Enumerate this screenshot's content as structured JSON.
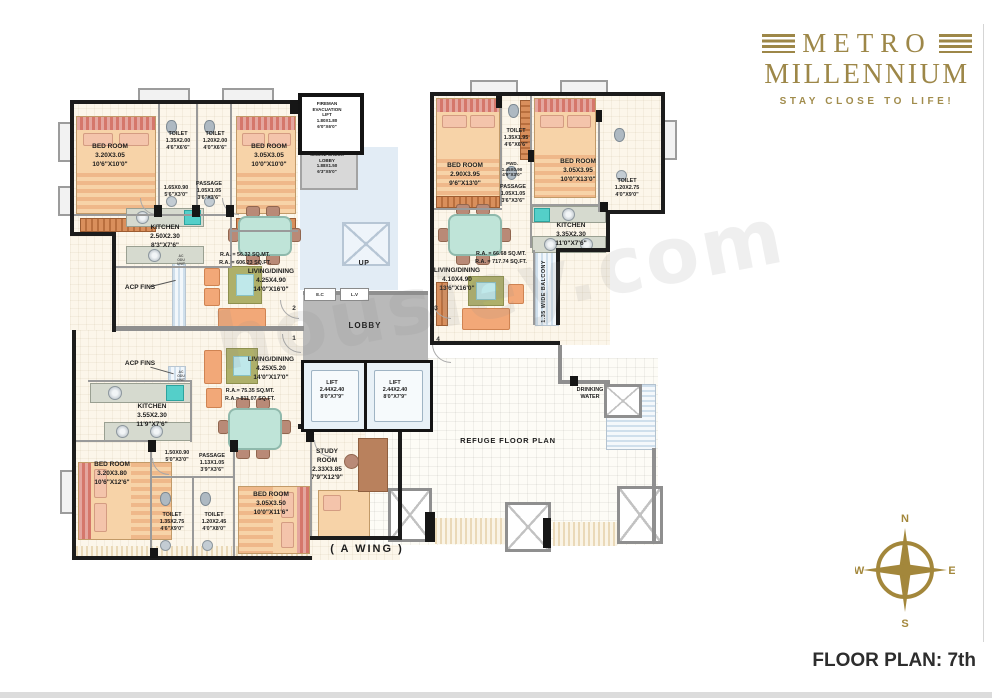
{
  "brand": {
    "name_line1": "METRO",
    "name_line2": "MILLENNIUM",
    "tagline": "STAY CLOSE TO LIFE!"
  },
  "watermark": "housiey.com",
  "plan_title": "FLOOR PLAN: 7th",
  "wing": "( A WING )",
  "compass": {
    "n": "N",
    "e": "E",
    "s": "S",
    "w": "W"
  },
  "core": {
    "fireman_lift": {
      "l1": "FIREMAN",
      "l2": "EVACUATION",
      "l3": "LIFT",
      "dim_m": "1.80X1.80",
      "dim_ft": "6'0\"X6'0\""
    },
    "smoke_lobby": {
      "l1": "SMOKE CHECK",
      "l2": "LOBBY",
      "dim_m": "1.88X1.50",
      "dim_ft": "6'3\"X5'0\""
    },
    "up": "UP",
    "ec": "E.C",
    "lv": "L.V",
    "lobby": "LOBBY",
    "lift": {
      "name": "LIFT",
      "dim_m": "2.44X2.40",
      "dim_ft": "8'0\"X7'9\""
    },
    "flat1": "1",
    "flat2": "2",
    "flat3": "3",
    "flat4": "4"
  },
  "flat_top_left": {
    "bedroom1": {
      "name": "BED ROOM",
      "dim_m": "3.20X3.05",
      "dim_ft": "10'6\"X10'0\""
    },
    "toilet1": {
      "name": "TOILET",
      "dim_m": "1.35X2.00",
      "dim_ft": "4'6\"X6'6\""
    },
    "toilet2": {
      "name": "TOILET",
      "dim_m": "1.20X2.00",
      "dim_ft": "4'0\"X6'6\""
    },
    "bedroom2": {
      "name": "BED ROOM",
      "dim_m": "3.05X3.05",
      "dim_ft": "10'0\"X10'0\""
    },
    "lobby_dim": {
      "dim_m": "1.65X0.90",
      "dim_ft": "5'6\"X3'0\""
    },
    "passage": {
      "name": "PASSAGE",
      "dim_m": "1.05X1.05",
      "dim_ft": "3'6\"X3'6\""
    },
    "kitchen": {
      "name": "KITCHEN",
      "dim_m": "2.50X2.30",
      "dim_ft": "8'3\"X7'6\""
    },
    "ra_mt": "R.A. = 56.32 SQ.MT.",
    "ra_ft": "R.A. = 606.23 SQ.FT.",
    "living": {
      "name": "LIVING/DINING",
      "dim_m": "4.25X4.90",
      "dim_ft": "14'0\"X16'0\""
    }
  },
  "flat_top_right": {
    "bedroom1": {
      "name": "BED ROOM",
      "dim_m": "2.90X3.95",
      "dim_ft": "9'6\"X13'0\""
    },
    "toilet1": {
      "name": "TOILET",
      "dim_m": "1.35X1.95",
      "dim_ft": "4'6\"X6'6\""
    },
    "pwd": {
      "name": "PWD.",
      "dim_m": "1.45X0.90",
      "dim_ft": "4'9\"X3'0\""
    },
    "passage": {
      "name": "PASSAGE",
      "dim_m": "1.05X1.05",
      "dim_ft": "3'6\"X3'6\""
    },
    "bedroom2": {
      "name": "BED ROOM",
      "dim_m": "3.05X3.95",
      "dim_ft": "10'0\"X13'0\""
    },
    "toilet2": {
      "name": "TOILET",
      "dim_m": "1.20X2.75",
      "dim_ft": "4'0\"X9'0\""
    },
    "kitchen": {
      "name": "KITCHEN",
      "dim_m": "3.35X2.30",
      "dim_ft": "11'0\"X7'6\""
    },
    "ra_mt": "R.A. = 66.68 SQ.MT.",
    "ra_ft": "R.A. = 717.74 SQ.FT.",
    "living": {
      "name": "LIVING/DINING",
      "dim_m": "4.10X4.90",
      "dim_ft": "13'6\"X16'0\""
    },
    "balcony": "1.35 WIDE BALCONY"
  },
  "flat_bottom_left": {
    "kitchen": {
      "name": "KITCHEN",
      "dim_m": "3.55X2.30",
      "dim_ft": "11'9\"X7'6\""
    },
    "living": {
      "name": "LIVING/DINING",
      "dim_m": "4.25X5.20",
      "dim_ft": "14'0\"X17'0\""
    },
    "ra_mt": "R.A.= 75.35 SQ.MT.",
    "ra_ft": "R.A.= 811.07 SQ.FT.",
    "lobby_dim": {
      "dim_m": "1.50X0.90",
      "dim_ft": "5'0\"X3'0\""
    },
    "passage": {
      "name": "PASSAGE",
      "dim_m": "1.13X1.05",
      "dim_ft": "3'9\"X3'6\""
    },
    "bedroom1": {
      "name": "BED ROOM",
      "dim_m": "3.20X3.80",
      "dim_ft": "10'6\"X12'6\""
    },
    "toilet1": {
      "name": "TOILET",
      "dim_m": "1.35X2.75",
      "dim_ft": "4'6\"X9'0\""
    },
    "toilet2": {
      "name": "TOILET",
      "dim_m": "1.20X2.45",
      "dim_ft": "4'0\"X8'0\""
    },
    "bedroom2": {
      "name": "BED ROOM",
      "dim_m": "3.05X3.50",
      "dim_ft": "10'0\"X11'6\""
    },
    "study": {
      "name1": "STUDY",
      "name2": "ROOM",
      "dim_m": "2.33X3.85",
      "dim_ft": "7'9\"X12'9\""
    }
  },
  "refuge": {
    "label": "REFUGE FLOOR PLAN",
    "drinking1": "DRINKING",
    "drinking2": "WATER"
  },
  "annotations": {
    "acp1": "ACP FINS",
    "acp2": "ACP FINS",
    "odu_l1": "AC",
    "odu_l2": "ODU",
    "odu_l3": "UNIT"
  },
  "colors": {
    "gold": "#9d8748",
    "wall": "#1c1c1c",
    "lobby_gray": "#b9b9b9",
    "stair_blue": "#e2ecf5"
  }
}
